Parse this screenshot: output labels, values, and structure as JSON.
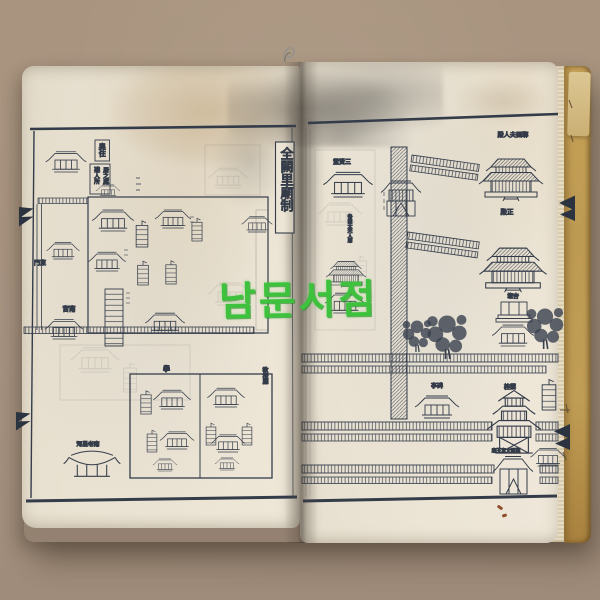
{
  "scene": {
    "background_color": "#a5917f",
    "watermark": {
      "text": "남문서점",
      "color": "#3ec23e"
    }
  },
  "book": {
    "paper_color": "#ebe3d4",
    "cover_color": "#bd9a52",
    "ink_color": "#343c4a"
  },
  "map": {
    "title": "全闕里廟制",
    "left": {
      "note_box_1": "奧住",
      "note_box_2a": "殘人所",
      "note_box_2b": "居之處",
      "east_gate": "東門",
      "south_hall": "南宮",
      "school": "學",
      "instruction_hall": "敎授廳",
      "south_gate_label": "南老星河"
    },
    "right": {
      "lady_hall": "鄆國夫人殿",
      "three_sages_hall": "三賢堂",
      "lady_shrine": "魯國太夫人廟",
      "main_hall": "正殿",
      "apricot_altar": "杏壇",
      "stele_pavilion": "碑亭",
      "tower": "雲桂",
      "main_gate": "至聖文宣王廟"
    }
  }
}
